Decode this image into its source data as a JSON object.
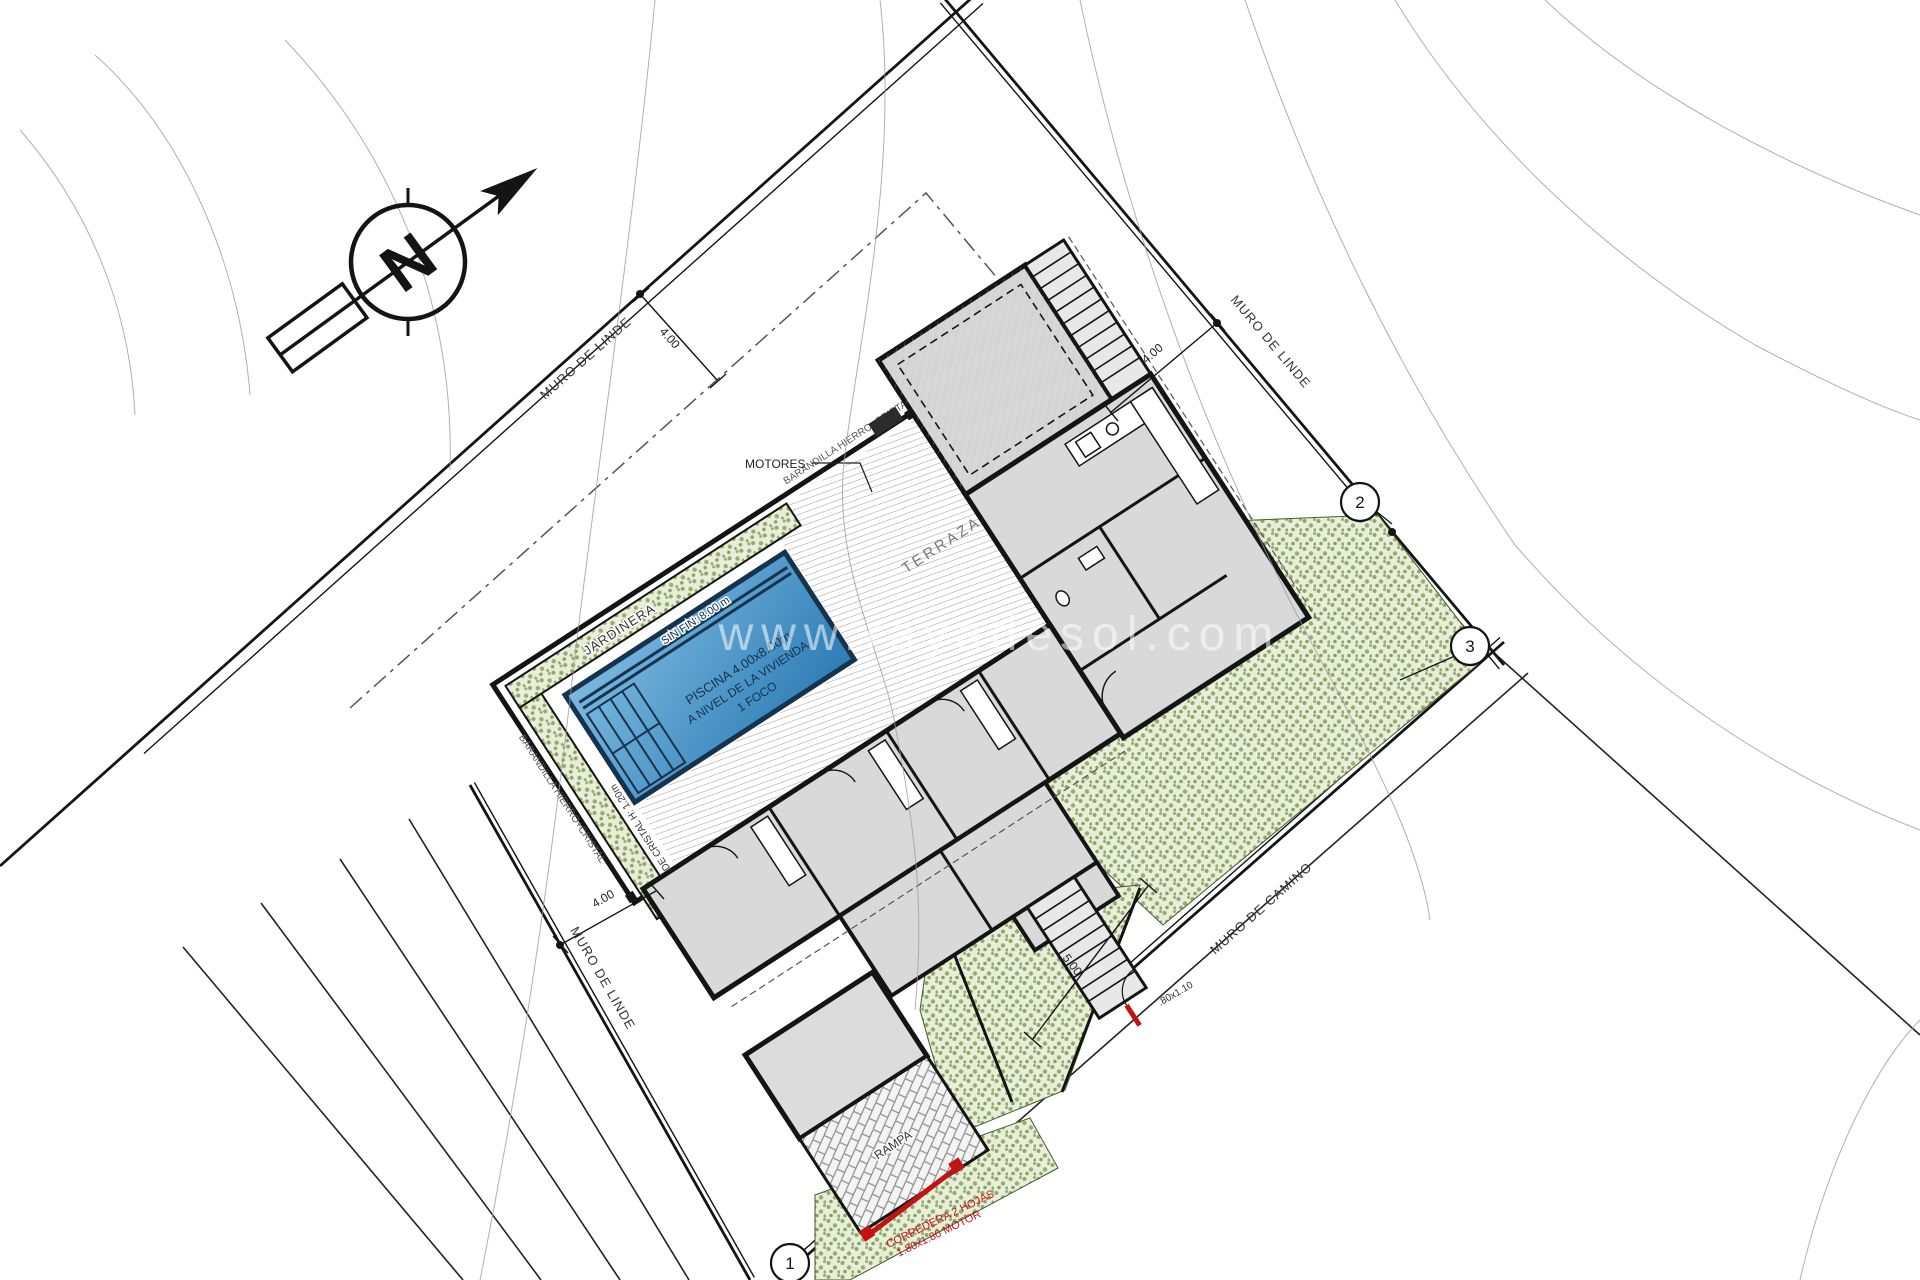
{
  "plan": {
    "north_letter": "N",
    "watermark": "www.rayadesol.com",
    "boundaries": {
      "muro_linde_top": "MURO DE LINDE",
      "muro_linde_right": "MURO DE LINDE",
      "muro_linde_left": "MURO DE LINDE",
      "muro_camino": "MURO DE CAMINO"
    },
    "dimensions": {
      "setback_top": "4.00",
      "setback_right": "4.00",
      "setback_left": "4.00",
      "garden": "5.00"
    },
    "markers": {
      "m1": "1",
      "m2": "2",
      "m3": "3"
    },
    "pool": {
      "line1": "PISCINA 4.00x8.00m",
      "line2": "A NIVEL DE LA VIVIENDA",
      "line3": "1 FOCO",
      "edge": "SIN FIN: 8.00 m",
      "glass_wall": "MURO DE CRISTAL H: 1.20m"
    },
    "labels": {
      "jardinera": "JARDINERA",
      "terraza": "TERRAZA",
      "motores": "MOTORES",
      "rampa": "RAMPA",
      "barandilla_sw": "BARANDILLA HIERRO+CRISTAL",
      "barandilla_ne": "BARANDILLA HIERRO+CRISTAL"
    },
    "gates": {
      "sliding_line1": "CORREDERA 2 HOJAS",
      "sliding_line2": "1.80x1.80 MOTOR",
      "pedestrian": ".80x1.10"
    },
    "colors": {
      "pool_light": "#7cb9e0",
      "pool_dark": "#2d7cb5",
      "pool_border": "#16334e",
      "green_bg": "#e9eed9",
      "green_dot": "#8fa870",
      "wall": "#141414",
      "red": "#c11313",
      "floor_grey": "#d9d9d9"
    }
  }
}
